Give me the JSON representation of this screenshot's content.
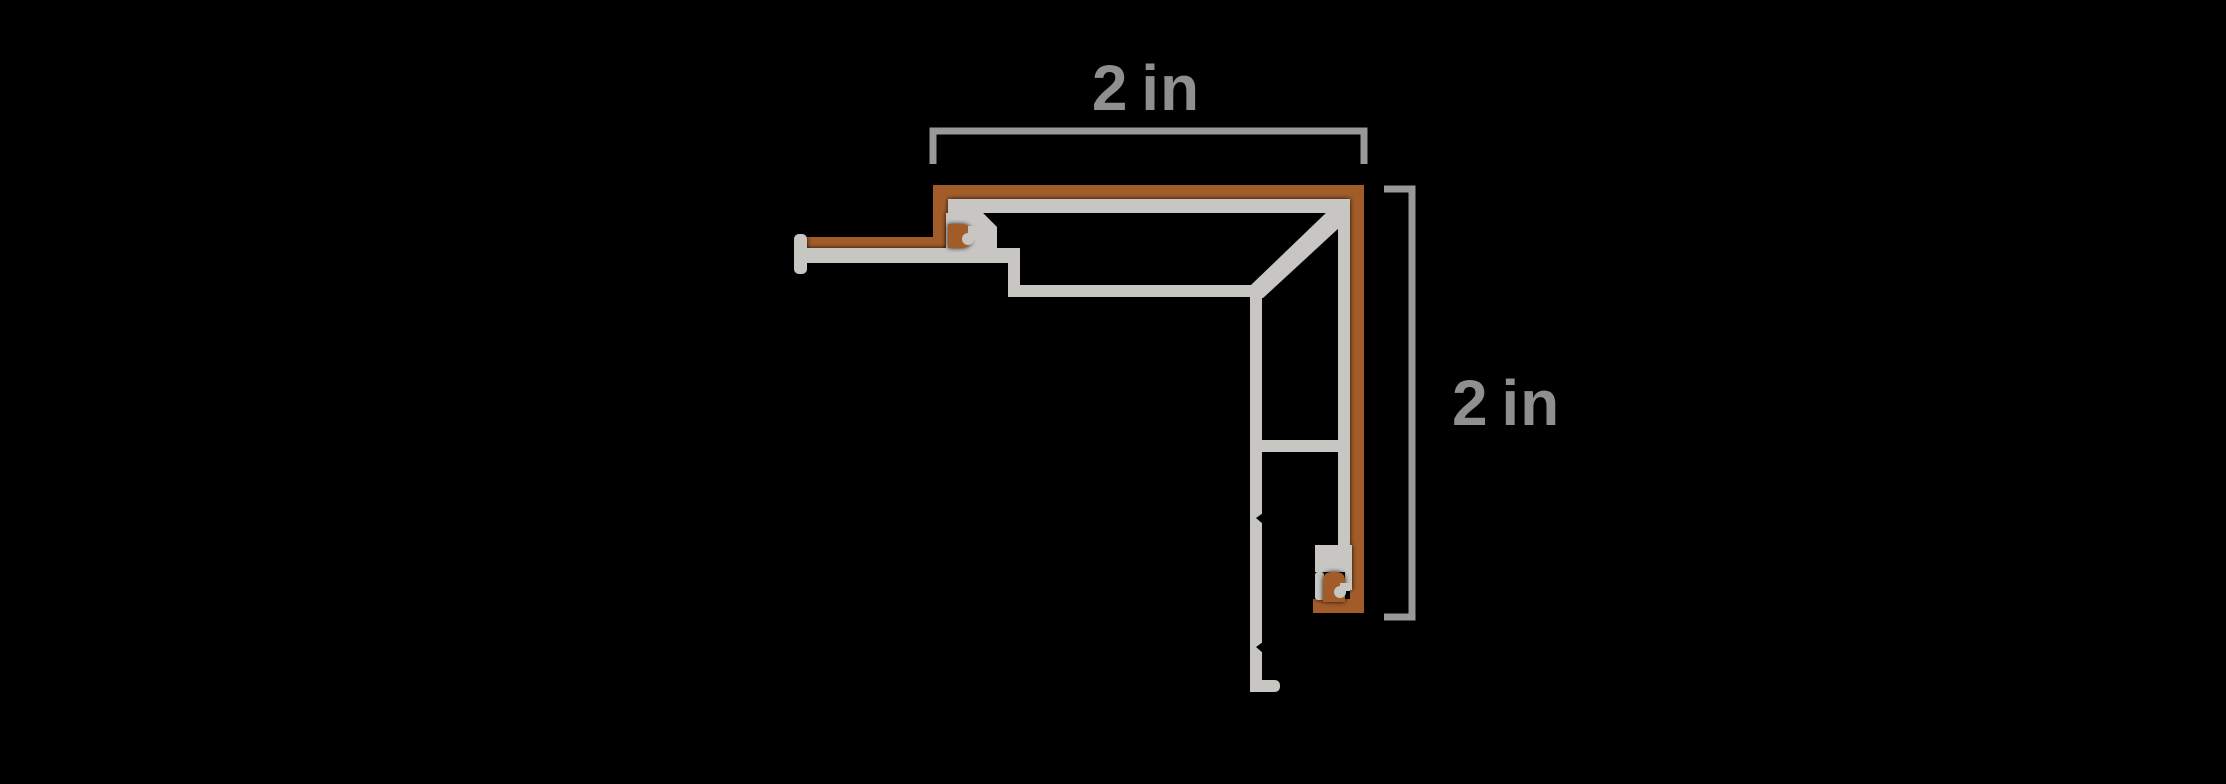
{
  "diagram": {
    "dimensions": {
      "width_label": "2 in",
      "height_label": "2 in"
    }
  },
  "colors": {
    "background": "#000000",
    "laminate_brown": "#a25b2b",
    "aluminum_gray": "#c8c6c2",
    "dimension_line": "#999999",
    "dimension_text": "#8f8f8f",
    "notch_black": "#000000"
  }
}
